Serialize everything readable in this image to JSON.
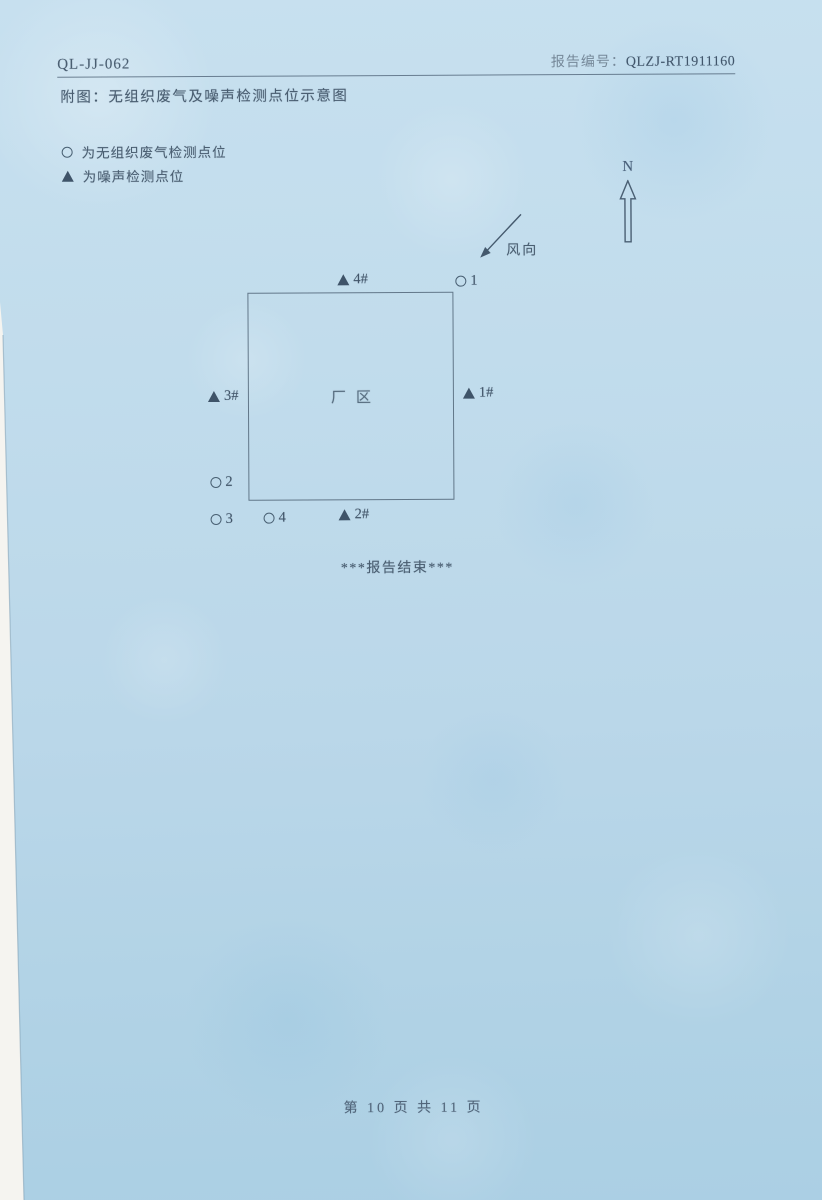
{
  "header": {
    "doc_code": "QL-JJ-062",
    "report_label": "报告编号：",
    "report_number": "QLZJ-RT1911160"
  },
  "title": "附图：无组织废气及噪声检测点位示意图",
  "legend": {
    "gas": "为无组织废气检测点位",
    "noise": "为噪声检测点位"
  },
  "compass": {
    "north_label": "N"
  },
  "wind_label": "风向",
  "diagram": {
    "area_label": "厂区",
    "markers": {
      "noise4": "4#",
      "gas1": "1",
      "noise3": "3#",
      "noise1": "1#",
      "gas2": "2",
      "gas3": "3",
      "gas4": "4",
      "noise2": "2#"
    }
  },
  "end_text": "***报告结束***",
  "footer": {
    "page_text": "第 10 页  共 11 页"
  },
  "colors": {
    "paper": "#bedaec",
    "ink": "#475b6e"
  }
}
